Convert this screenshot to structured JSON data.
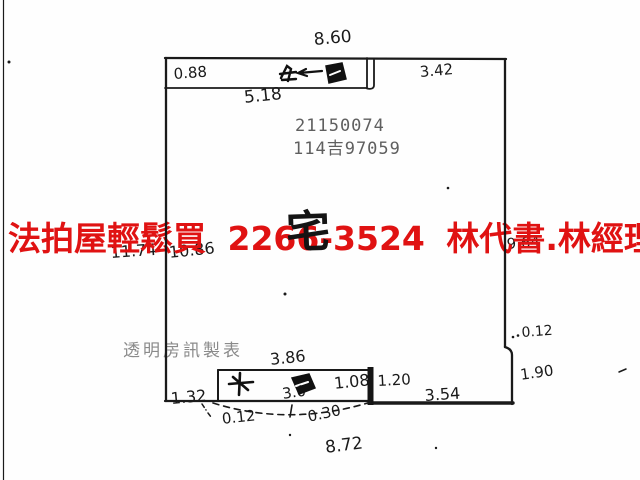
{
  "watermark": {
    "text": "法拍屋輕鬆買  2266-3524  林代書.林經理",
    "color": "#e01212"
  },
  "stamps": {
    "serial_line1": "21150074",
    "serial_line2": "114吉97059",
    "maker": "透明房訊製表",
    "room_label": "宅"
  },
  "dims": {
    "top_overall": "8.60",
    "top_window_inset": "0.88",
    "top_window_width": "5.18",
    "top_right": "3.42",
    "left_outer": "11.74",
    "left_inner": "10.86",
    "right_inner": "9.64",
    "right_step": "0.12",
    "right_lower": "1.90",
    "bottom_left": "1.32",
    "bottom_window_width": "3.86",
    "bottom_window_span": "3.0",
    "bottom_window_right": "1.08",
    "bottom_gap": "1.20",
    "bottom_right": "3.54",
    "bottom_step": "0.12",
    "bottom_arc": "0.30",
    "bottom_overall": "8.72"
  },
  "icons": {
    "top_window_marks": "handwritten-window-scribble with left arrow",
    "bottom_window_marks": "handwritten-window-scribble",
    "door_swing": "dashed-arc"
  },
  "colors": {
    "watermark_red": "#e01212",
    "ink": "#1a1a1a",
    "stamp_gray": "#5f5f5f",
    "maker_gray": "#8a8a8a",
    "background": "#fefefe"
  }
}
